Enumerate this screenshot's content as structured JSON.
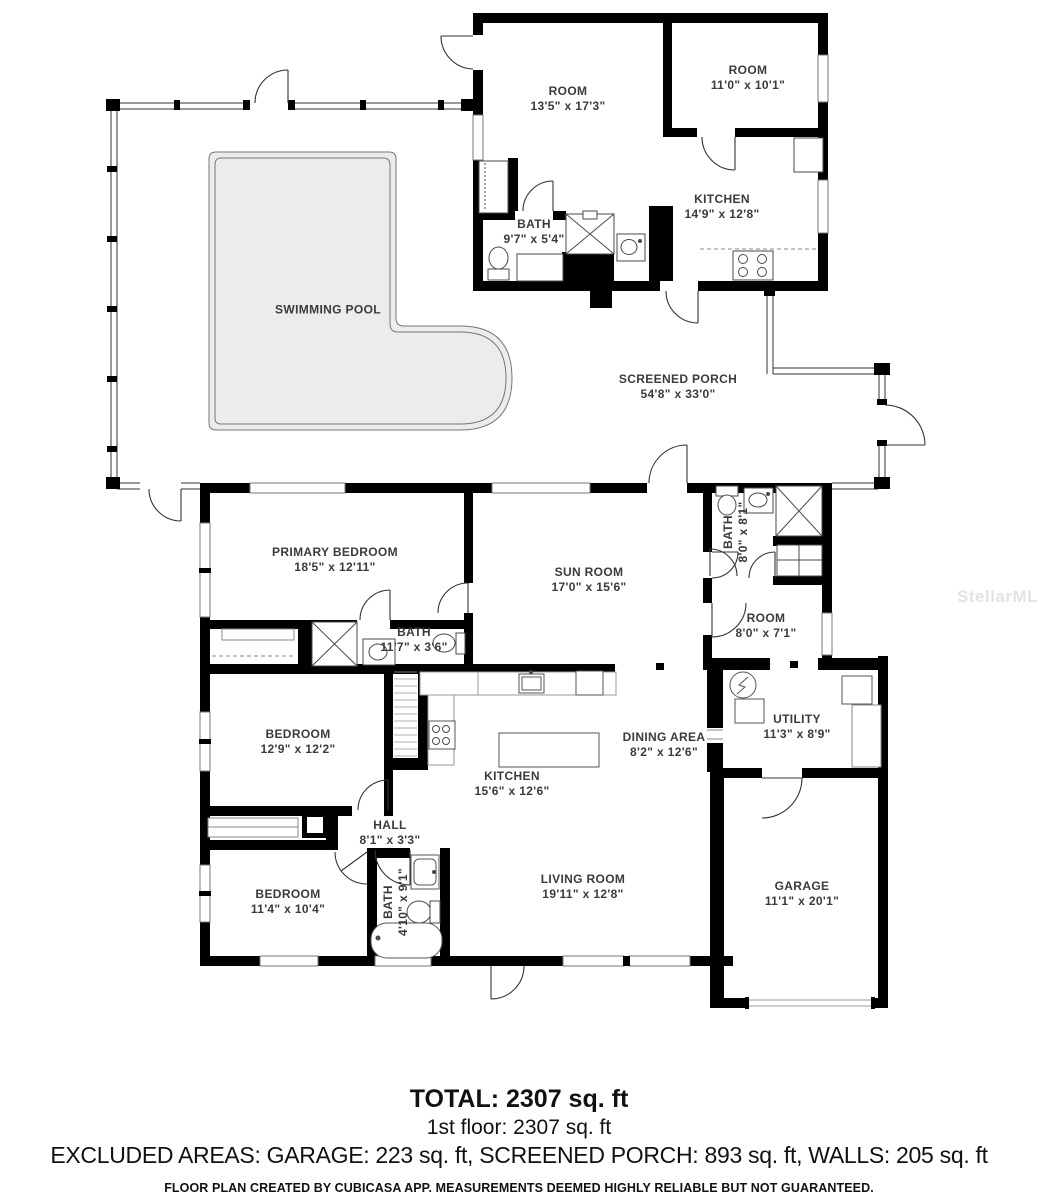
{
  "watermark": "StellarMLS",
  "rooms": [
    {
      "id": "room-upper-left",
      "name": "ROOM",
      "dims": "13'5\" x 17'3\""
    },
    {
      "id": "room-upper-right",
      "name": "ROOM",
      "dims": "11'0\" x 10'1\""
    },
    {
      "id": "kitchen-upper",
      "name": "KITCHEN",
      "dims": "14'9\" x 12'8\""
    },
    {
      "id": "bath-upper",
      "name": "BATH",
      "dims": "9'7\" x 5'4\""
    },
    {
      "id": "swimming-pool",
      "name": "SWIMMING POOL",
      "dims": ""
    },
    {
      "id": "screened-porch",
      "name": "SCREENED PORCH",
      "dims": "54'8\" x 33'0\""
    },
    {
      "id": "primary-bedroom",
      "name": "PRIMARY BEDROOM",
      "dims": "18'5\" x 12'11\""
    },
    {
      "id": "sun-room",
      "name": "SUN ROOM",
      "dims": "17'0\" x 15'6\""
    },
    {
      "id": "bath-primary",
      "name": "BATH",
      "dims": "11'7\" x 3'6\""
    },
    {
      "id": "bath-ensuite",
      "name": "BATH",
      "dims": "8'0\" x 8'1\""
    },
    {
      "id": "room-middle",
      "name": "ROOM",
      "dims": "8'0\" x 7'1\""
    },
    {
      "id": "bedroom-middle",
      "name": "BEDROOM",
      "dims": "12'9\" x 12'2\""
    },
    {
      "id": "kitchen-main",
      "name": "KITCHEN",
      "dims": "15'6\" x 12'6\""
    },
    {
      "id": "dining-area",
      "name": "DINING AREA",
      "dims": "8'2\" x 12'6\""
    },
    {
      "id": "utility",
      "name": "UTILITY",
      "dims": "11'3\" x 8'9\""
    },
    {
      "id": "hall",
      "name": "HALL",
      "dims": "8'1\" x 3'3\""
    },
    {
      "id": "bedroom-lower",
      "name": "BEDROOM",
      "dims": "11'4\" x 10'4\""
    },
    {
      "id": "bath-hall",
      "name": "BATH",
      "dims": "4'10\" x 9'1\""
    },
    {
      "id": "living-room",
      "name": "LIVING ROOM",
      "dims": "19'11\" x 12'8\""
    },
    {
      "id": "garage",
      "name": "GARAGE",
      "dims": "11'1\" x 20'1\""
    }
  ],
  "summary": {
    "total": "TOTAL: 2307 sq. ft",
    "floor1": "1st floor: 2307 sq. ft",
    "excluded": "EXCLUDED AREAS: GARAGE: 223 sq. ft, SCREENED PORCH: 893 sq. ft, WALLS: 205 sq. ft",
    "disclaimer": "FLOOR PLAN CREATED BY CUBICASA APP. MEASUREMENTS DEEMED HIGHLY RELIABLE BUT NOT GUARANTEED."
  }
}
